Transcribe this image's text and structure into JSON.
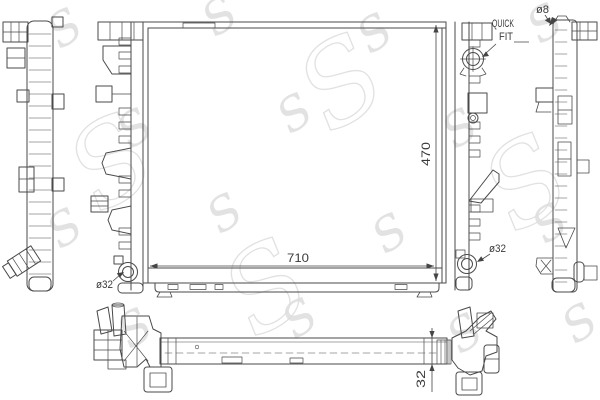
{
  "drawing": {
    "kind": "radiator technical line drawing",
    "views": [
      "far-left-profile",
      "left-profile",
      "front",
      "right-profile",
      "far-right-profile",
      "bottom"
    ]
  },
  "dimensions": {
    "width": "710",
    "height": "470",
    "core_thickness": "32"
  },
  "labels": {
    "quick_fit_line1": "QUICK",
    "quick_fit_line2": "FIT",
    "dia8": "ø8",
    "dia32_left": "ø32",
    "dia32_right": "ø32"
  },
  "watermark": {
    "letter": "S"
  },
  "colors": {
    "line": "#4a4a4a",
    "label": "#3a3a3a",
    "watermark": "#d6d6d6",
    "background": "#ffffff"
  }
}
